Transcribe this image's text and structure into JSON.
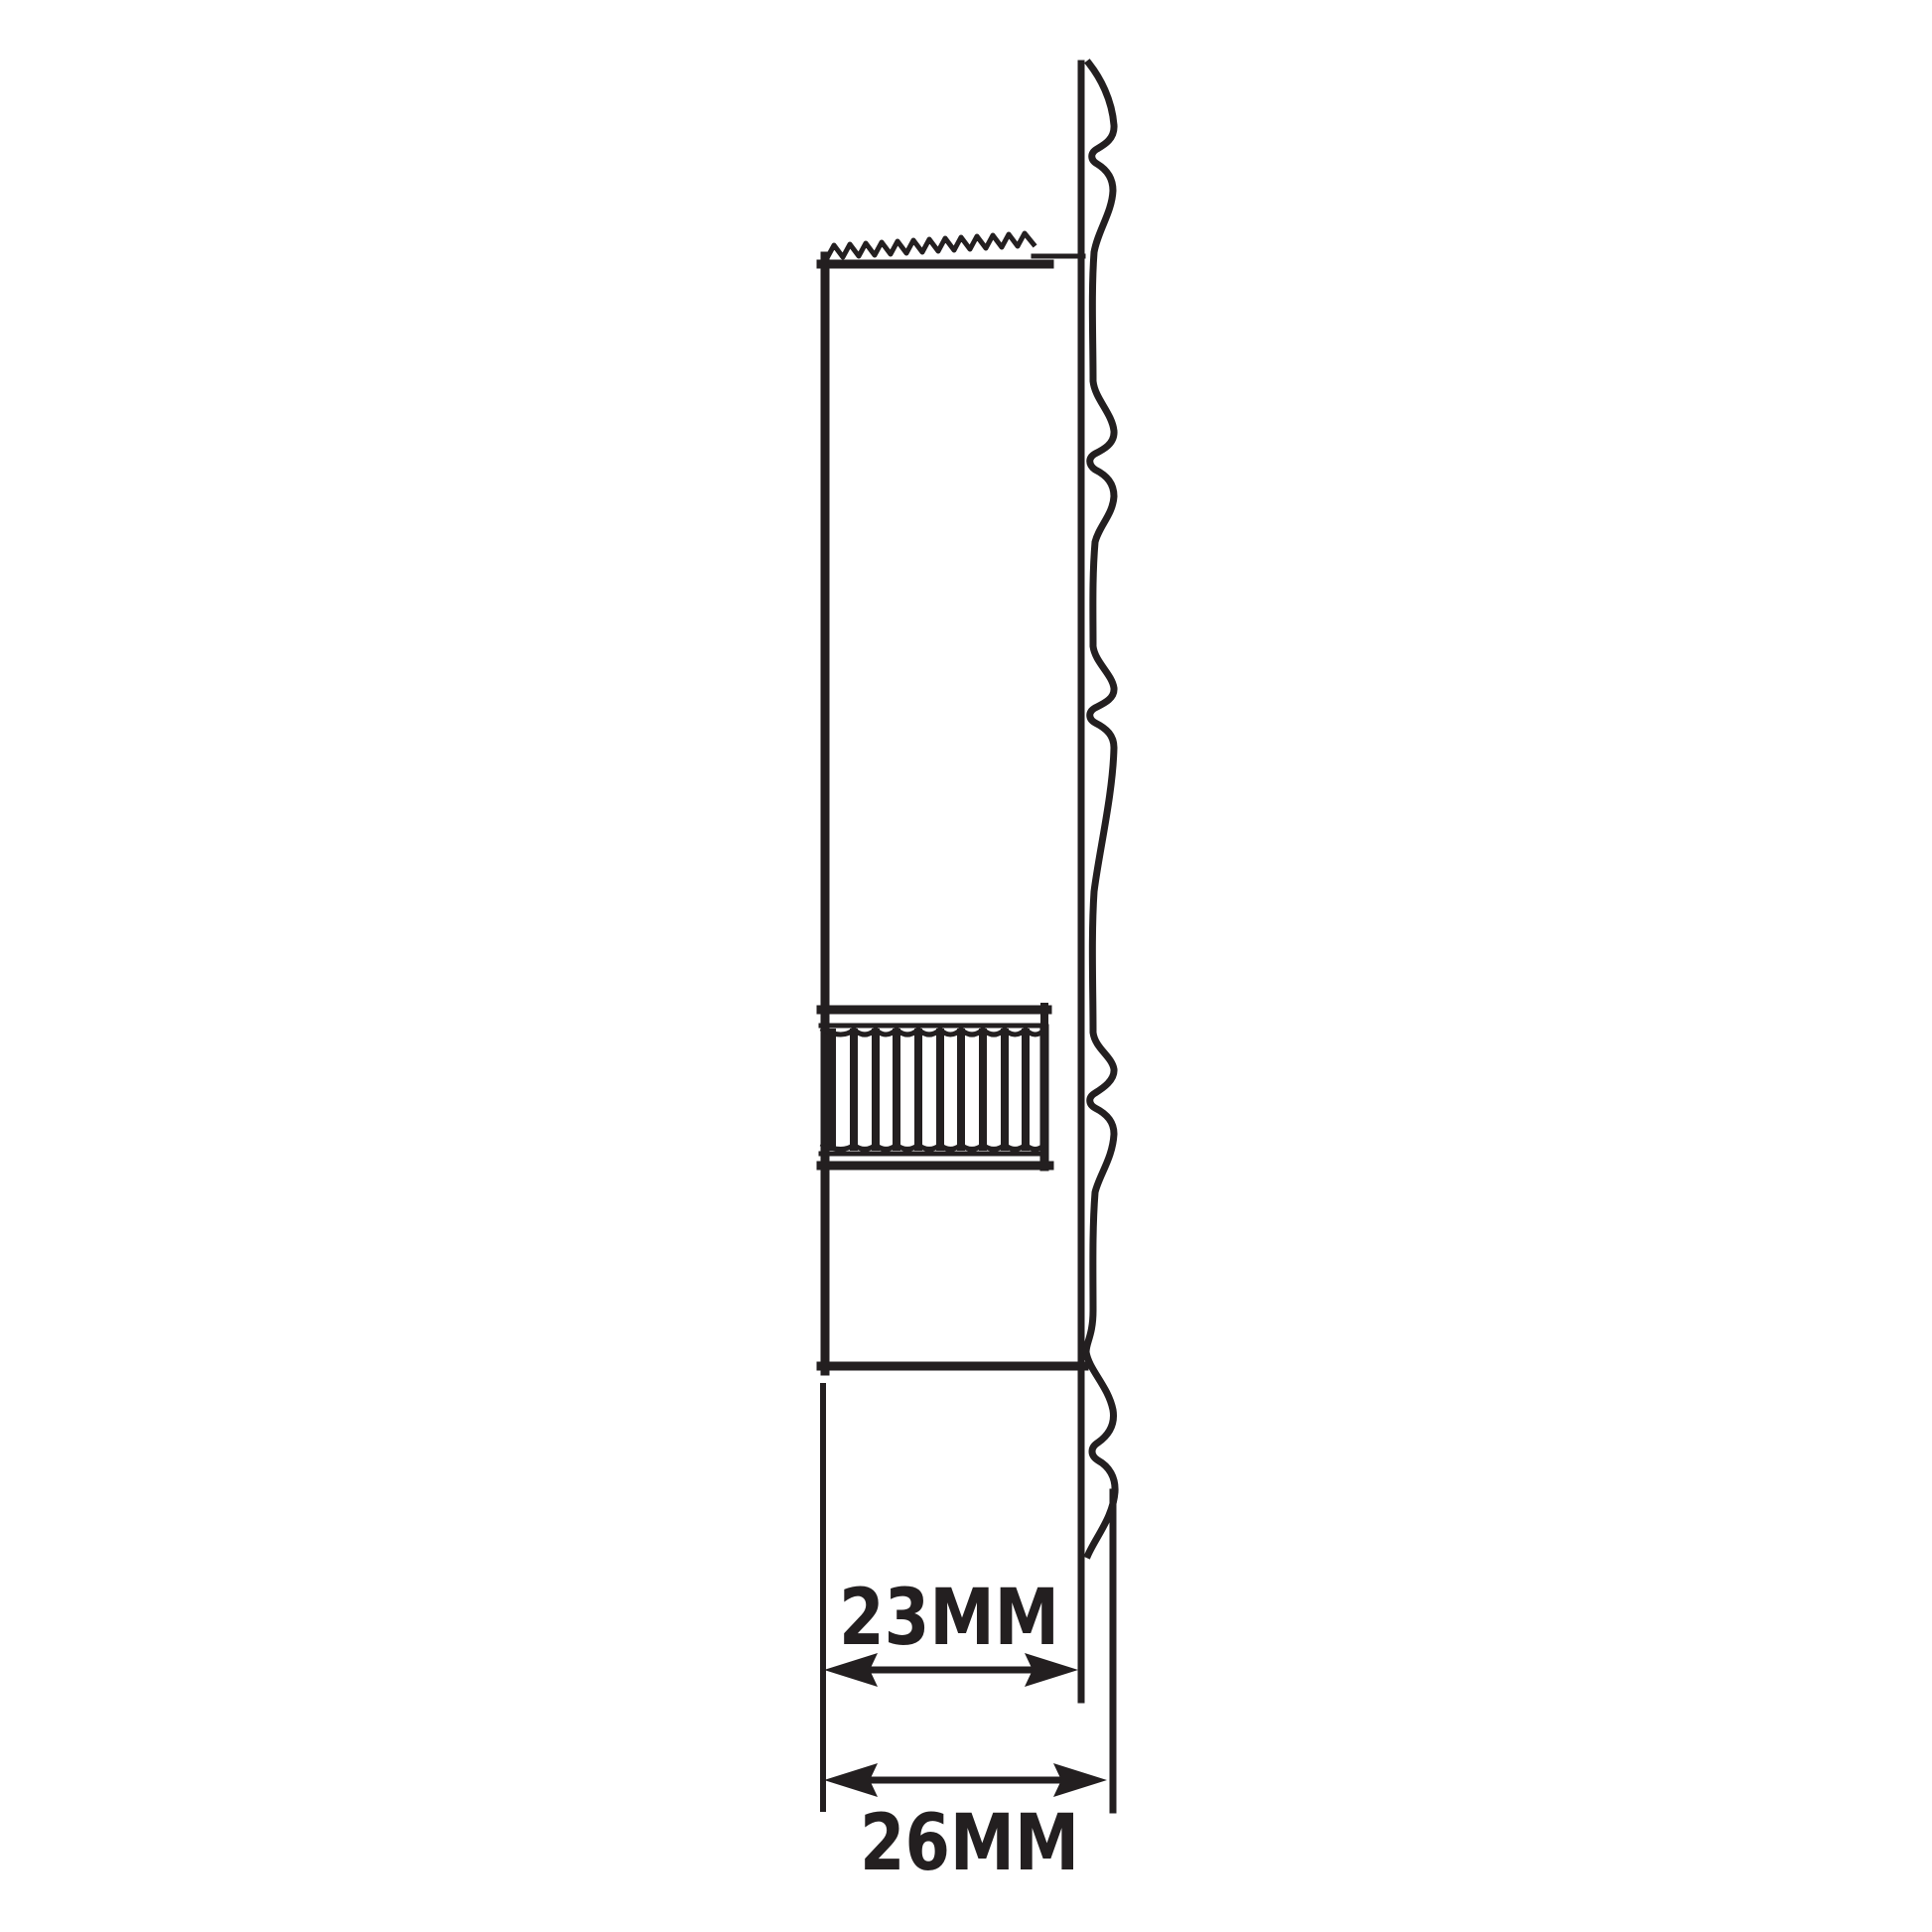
{
  "diagram": {
    "colors": {
      "line": "#231f20",
      "background": "#ffffff"
    },
    "dimensions": {
      "neck": {
        "label": "23MM"
      },
      "outer": {
        "label": "26MM"
      }
    }
  }
}
